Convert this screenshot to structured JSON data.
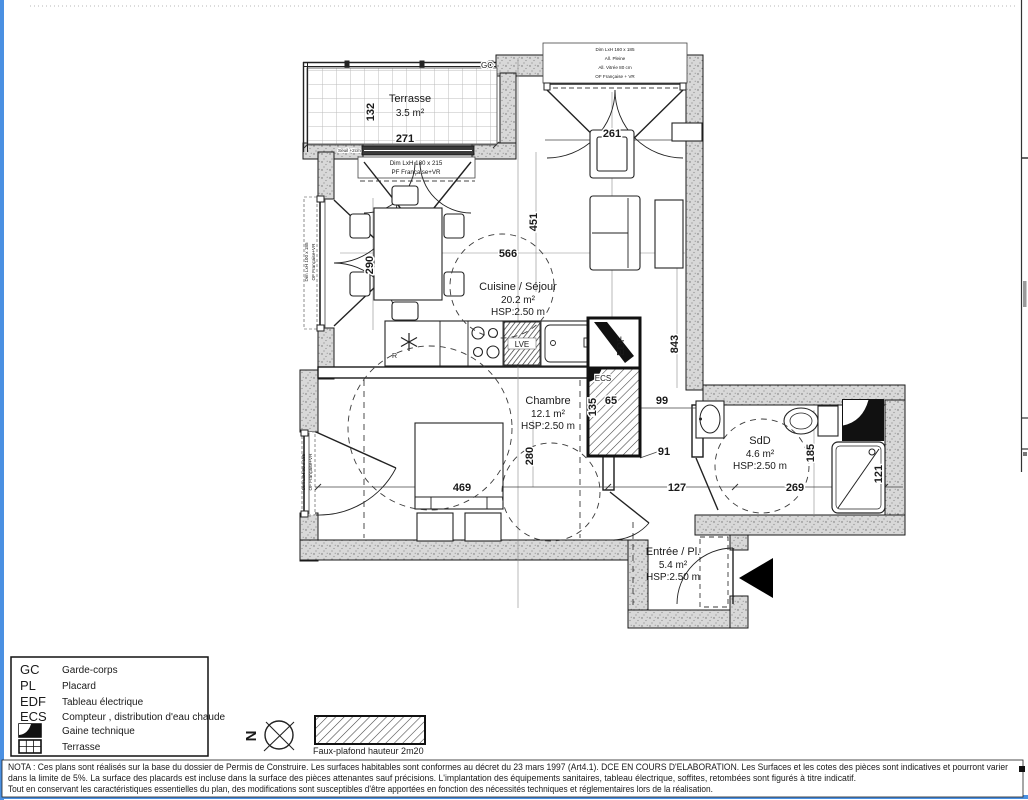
{
  "plan": {
    "rooms": {
      "terrasse": {
        "name": "Terrasse",
        "area": "3.5 m²"
      },
      "cuisine": {
        "name": "Cuisine / Séjour",
        "area": "20.2 m²",
        "hsp": "HSP:2.50 m"
      },
      "chambre": {
        "name": "Chambre",
        "area": "12.1 m²",
        "hsp": "HSP:2.50 m"
      },
      "sdd": {
        "name": "SdD",
        "area": "4.6 m²",
        "hsp": "HSP:2.50 m"
      },
      "entree": {
        "name": "Entrée / Pl.",
        "area": "5.4 m²",
        "hsp": "HSP:2.50 m"
      }
    },
    "dims": {
      "d132": "132",
      "d271": "271",
      "d261": "261",
      "d451": "451",
      "d566": "566",
      "d290": "290",
      "d843": "843",
      "d135": "135",
      "d65": "65",
      "d99": "99",
      "d91": "91",
      "d280": "280",
      "d469": "469",
      "d127": "127",
      "d269": "269",
      "d185": "185",
      "d121": "121"
    },
    "labels": {
      "gc": "GC",
      "seuil": "Seuil +2cm",
      "r": "R",
      "lve": "LVE",
      "edf": "EDF",
      "ecs": "ECS"
    },
    "win_top": [
      "Dim LxH 160 x 185",
      "All. Pleine",
      "All. Vitrée 80 cm",
      "OF Française + VR"
    ],
    "door_terrasse": [
      "Dim LxH 180 x 215",
      "PF Française+VR"
    ],
    "win_left_upper": [
      "Dim LxH 100 x 185",
      "OF Française+VR"
    ],
    "win_left_lower": [
      "Dim LxH 90 x 185",
      "OF Française+VR"
    ]
  },
  "legend": {
    "items": [
      {
        "key": "GC",
        "label": "Garde-corps"
      },
      {
        "key": "PL",
        "label": "Placard"
      },
      {
        "key": "EDF",
        "label": "Tableau électrique"
      },
      {
        "key": "ECS",
        "label": "Compteur , distribution d'eau chaude"
      },
      {
        "key": "",
        "label": "Gaine technique"
      },
      {
        "key": "",
        "label": "Terrasse"
      }
    ]
  },
  "compass": {
    "north": "N"
  },
  "faux_plafond_label": "Faux-plafond hauteur 2m20",
  "nota": {
    "line1": "NOTA : Ces plans sont réalisés sur la base du dossier de Permis de Construire. Les surfaces habitables sont conformes au décret du 23 mars 1997 (Art4.1). DCE EN COURS D'ELABORATION. Les Surfaces et les cotes des pièces sont indicatives et pourront varier",
    "line2": "dans la limite de 5%. La surface des placards est incluse dans la surface des pièces attenantes sauf précisions. L'implantation des équipements sanitaires, tableau électrique, soffites, retombées sont figurés à titre indicatif.",
    "line3": "Tout en conservant les caractéristiques essentielles du plan, des modifications sont susceptibles d'être apportées en fonction des nécessités techniques et réglementaires lors de la réalisation."
  },
  "colors": {
    "frame_blue": "#4a90e2",
    "wall_gray": "#d8d8d8",
    "line_black": "#1a1a1a"
  }
}
